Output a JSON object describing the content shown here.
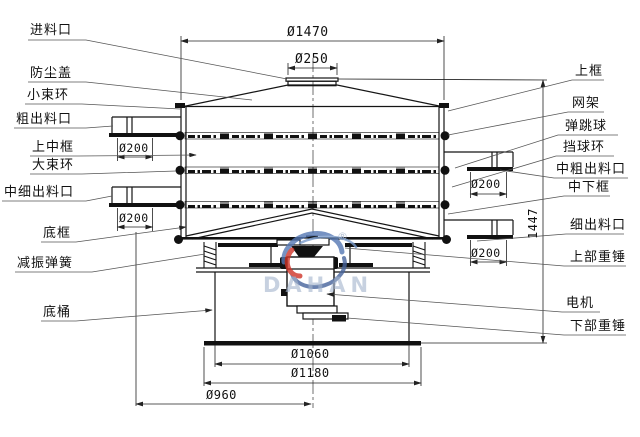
{
  "drawing": {
    "watermark": {
      "brand": "DAHAN",
      "registered": "®"
    },
    "labels": {
      "left": [
        "进料口",
        "防尘盖",
        "小束环",
        "粗出料口",
        "上中框",
        "大束环",
        "中细出料口",
        "底框",
        "减振弹簧",
        "底桶"
      ],
      "right": [
        "上框",
        "网架",
        "弹跳球",
        "挡球环",
        "中粗出料口",
        "中下框",
        "细出料口",
        "上部重锤",
        "电机",
        "下部重锤"
      ]
    },
    "dimensions": {
      "body_diameter": "Ø1470",
      "inlet_diameter": "Ø250",
      "outlet_upper_left": "Ø200",
      "outlet_lower_left": "Ø200",
      "outlet_upper_right": "Ø200",
      "outlet_lower_right": "Ø200",
      "total_height": "1447",
      "base_inner_diameter": "Ø1060",
      "base_plate_diameter": "Ø1180",
      "base_half_span": "Ø960"
    }
  }
}
